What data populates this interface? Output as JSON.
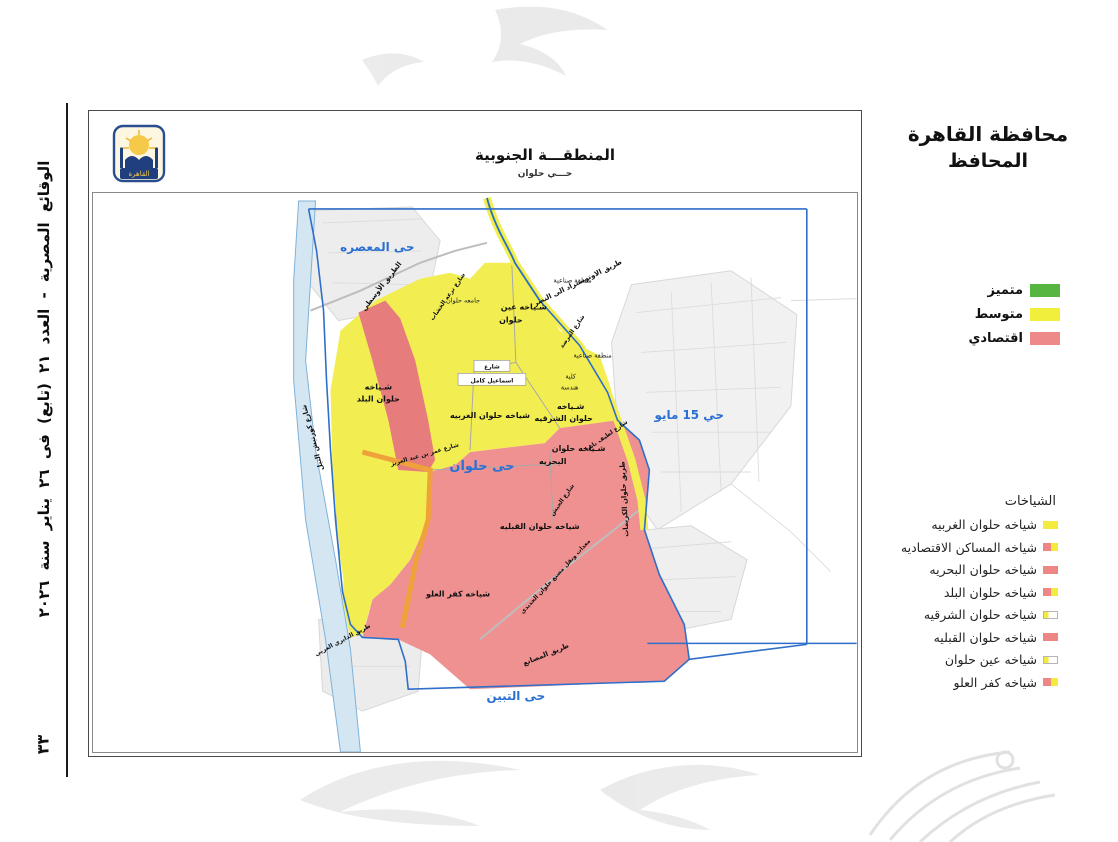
{
  "gazette": {
    "issue_line": "الوقائع المصرية - العدد ٢١ (تابع) فى ٢٦ يناير سنة ٢٠٢٦",
    "page_number": "٣٣"
  },
  "header": {
    "title": "محافظة القاهرة",
    "subtitle": "المحافظ"
  },
  "quality_legend": {
    "items": [
      {
        "label": "متميز",
        "swatch": {
          "type": "solid",
          "colors": [
            "#56b440"
          ]
        }
      },
      {
        "label": "متوسط",
        "swatch": {
          "type": "solid",
          "colors": [
            "#f2ee3c"
          ]
        }
      },
      {
        "label": "اقتصادي",
        "swatch": {
          "type": "solid",
          "colors": [
            "#ee8989"
          ]
        }
      }
    ]
  },
  "sheyakhat_legend": {
    "title": "الشياخات",
    "items": [
      {
        "label": "شياخه حلوان الغربيه",
        "swatch": {
          "type": "solid",
          "colors": [
            "#f3ec3e"
          ]
        }
      },
      {
        "label": "شياخه المساكن الاقتصاديه",
        "swatch": {
          "type": "split",
          "colors": [
            "#ee8686",
            "#f3ec3e"
          ]
        }
      },
      {
        "label": "شياخه حلوان البحريه",
        "swatch": {
          "type": "solid",
          "colors": [
            "#ee8686"
          ]
        }
      },
      {
        "label": "شياخه حلوان البلد",
        "swatch": {
          "type": "split",
          "colors": [
            "#ee8686",
            "#f3ec3e"
          ]
        }
      },
      {
        "label": "شياخه حلوان الشرقيه",
        "swatch": {
          "type": "outline",
          "colors": [
            "#f3ec3e",
            "#ffffff"
          ]
        }
      },
      {
        "label": "شياخه حلوان القبليه",
        "swatch": {
          "type": "solid",
          "colors": [
            "#ee8686"
          ]
        }
      },
      {
        "label": "شياخه عين حلوان",
        "swatch": {
          "type": "outline",
          "colors": [
            "#f3ec3e",
            "#ffffff"
          ]
        }
      },
      {
        "label": "شياخه كفر العلو",
        "swatch": {
          "type": "split",
          "colors": [
            "#ee8686",
            "#f3ec3e"
          ]
        }
      }
    ]
  },
  "map": {
    "title": "المنطقـــة الجنوبية",
    "subtitle": "حـــي حلوان",
    "logo_text": "القاهرة",
    "colors": {
      "zone_yellow": "#f2ee52",
      "zone_pink": "#ef9191",
      "zone_red": "#e77c7c",
      "road_orange": "#f0a23a",
      "river": "#d4e6f2",
      "river_edge": "#7fb2d8",
      "boundary_blue": "#2f6fc9",
      "city_label_blue": "#2a6fd2",
      "road_green": "#44a93e"
    },
    "labels": [
      {
        "text": "حى المعصره",
        "x": 285,
        "y": 58,
        "cls": "city"
      },
      {
        "text": "حي 15 مايو",
        "x": 598,
        "y": 227,
        "cls": "city"
      },
      {
        "text": "حى حلوان",
        "x": 390,
        "y": 278,
        "cls": "city city-lg"
      },
      {
        "text": "حى التبين",
        "x": 424,
        "y": 509,
        "cls": "city"
      },
      {
        "text": "شـياخه",
        "x": 286,
        "y": 197,
        "cls": "area"
      },
      {
        "text": "حلوان البلد",
        "x": 286,
        "y": 209,
        "cls": "area"
      },
      {
        "text": "شياخه حلوان الغربيه",
        "x": 398,
        "y": 226,
        "cls": "area"
      },
      {
        "text": "شـياخه",
        "x": 479,
        "y": 217,
        "cls": "area"
      },
      {
        "text": "حلوان الشرقيه",
        "x": 472,
        "y": 229,
        "cls": "area"
      },
      {
        "text": "شـياخه حلوان",
        "x": 487,
        "y": 259,
        "cls": "area"
      },
      {
        "text": "البحريه",
        "x": 461,
        "y": 272,
        "cls": "area"
      },
      {
        "text": "شياخه حلوان القبليه",
        "x": 448,
        "y": 337,
        "cls": "area"
      },
      {
        "text": "شياخه كفر العلو",
        "x": 366,
        "y": 405,
        "cls": "area"
      },
      {
        "text": "شـياخه عين",
        "x": 432,
        "y": 117,
        "cls": "area"
      },
      {
        "text": "حلوان",
        "x": 419,
        "y": 130,
        "cls": "area"
      },
      {
        "text": "جامعه حلوان",
        "x": 371,
        "y": 110,
        "cls": "area-rg"
      },
      {
        "text": "منطقة صناعية",
        "x": 481,
        "y": 90,
        "cls": "area-rg"
      },
      {
        "text": "منطقة صناعية",
        "x": 501,
        "y": 165,
        "cls": "area-rg"
      },
      {
        "text": "كلية",
        "x": 479,
        "y": 186,
        "cls": "area-rg"
      },
      {
        "text": "هندسة",
        "x": 478,
        "y": 197,
        "cls": "area-rg"
      },
      {
        "text": "الطريق الأوسطي",
        "x": 291,
        "y": 95,
        "cls": "road",
        "rot": -52
      },
      {
        "text": "شارع ترعه الخشاب",
        "x": 357,
        "y": 105,
        "cls": "road-sm",
        "rot": -55
      },
      {
        "text": "طريق الاوتوستراد الى النصر",
        "x": 487,
        "y": 92,
        "cls": "road",
        "rot": -26
      },
      {
        "text": "شارع المرصد",
        "x": 482,
        "y": 140,
        "cls": "road-sm",
        "rot": -55
      },
      {
        "text": "شارع كورنيش النيل",
        "x": 222,
        "y": 245,
        "cls": "road",
        "rot": -105
      },
      {
        "text": "طريق حلوان الكريمات",
        "x": 535,
        "y": 307,
        "cls": "road",
        "rot": -93
      },
      {
        "text": "شارع عمر بن عبد العزيز",
        "x": 333,
        "y": 264,
        "cls": "road-sm",
        "rot": -16
      },
      {
        "text": "شارع لطيف باشا",
        "x": 516,
        "y": 245,
        "cls": "road-sm",
        "rot": -35
      },
      {
        "text": "شارع الجيش",
        "x": 472,
        "y": 309,
        "cls": "road-sm",
        "rot": -55
      },
      {
        "text": "معدات ونقل مصنع حلوان الحديدي",
        "x": 465,
        "y": 386,
        "cls": "road-sm",
        "rot": -47
      },
      {
        "text": "طريق المصانع",
        "x": 455,
        "y": 465,
        "cls": "road",
        "rot": -22
      },
      {
        "text": "طريق الدايري الغربي",
        "x": 251,
        "y": 450,
        "cls": "road-sm",
        "rot": -28
      },
      {
        "text": "شارع",
        "x": 400,
        "y": 176,
        "cls": "road-sm"
      },
      {
        "text": "اسماعيل كامل",
        "x": 400,
        "y": 190,
        "cls": "road-sm"
      }
    ]
  }
}
